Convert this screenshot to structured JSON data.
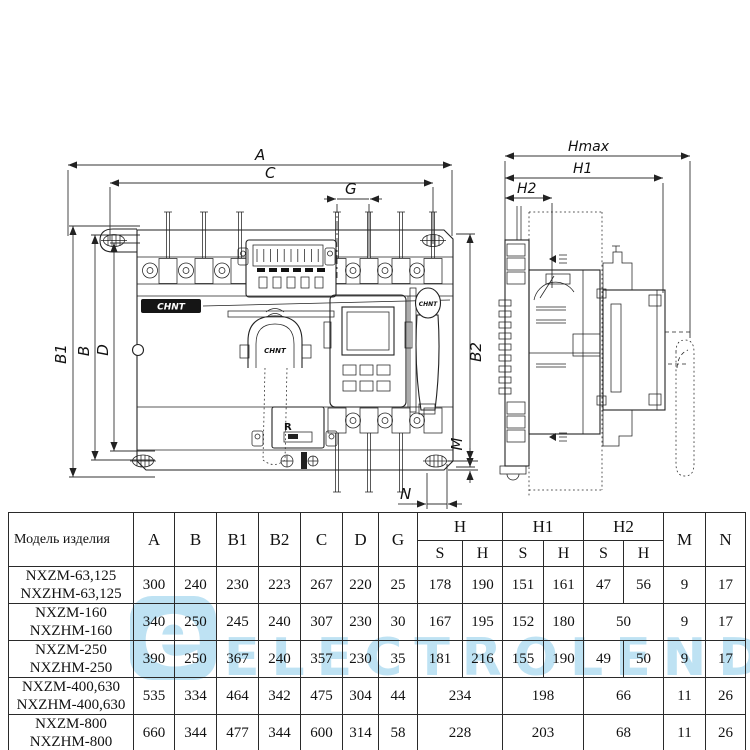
{
  "watermark": {
    "logo_letter": "e",
    "text": "ELECTROLEND",
    "accent_color": "#b3ddf1"
  },
  "drawing": {
    "front_view": {
      "dim_a": "A",
      "dim_c": "C",
      "dim_g": "G",
      "dim_b1": "B1",
      "dim_b": "B",
      "dim_d": "D",
      "dim_b2": "B2",
      "dim_m": "M",
      "dim_n": "N",
      "brand_plate": "CHNT",
      "brand_arch": "CHNT",
      "brand_handle": "CHNT",
      "relay_label": "R"
    },
    "side_view": {
      "dim_hmax": "Hmax",
      "dim_h1": "H1",
      "dim_h2": "H2"
    }
  },
  "table": {
    "header": {
      "model": "Модель изделия",
      "a": "A",
      "b": "B",
      "b1": "B1",
      "b2": "B2",
      "c": "C",
      "d": "D",
      "g": "G",
      "h": "H",
      "h1": "H1",
      "h2": "H2",
      "s1": "S",
      "hh1": "H",
      "s2": "S",
      "hh2": "H",
      "s3": "S",
      "hh3": "H",
      "m": "M",
      "n": "N"
    },
    "rows": [
      {
        "model1": "NXZM-63,125",
        "model2": "NXZHM-63,125",
        "a": "300",
        "b": "240",
        "b1": "230",
        "b2": "223",
        "c": "267",
        "d": "220",
        "g": "25",
        "hs": "178",
        "hh": "190",
        "h1s": "151",
        "h1h": "161",
        "h2s": "47",
        "h2h": "56",
        "m": "9",
        "n": "17"
      },
      {
        "model1": "NXZM-160",
        "model2": "NXZHM-160",
        "a": "340",
        "b": "250",
        "b1": "245",
        "b2": "240",
        "c": "307",
        "d": "230",
        "g": "30",
        "hs": "167",
        "hh": "195",
        "h1s": "152",
        "h1h": "180",
        "h2": "50",
        "m": "9",
        "n": "17"
      },
      {
        "model1": "NXZM-250",
        "model2": "NXZHM-250",
        "a": "390",
        "b": "250",
        "b1": "367",
        "b2": "240",
        "c": "357",
        "d": "230",
        "g": "35",
        "hs": "181",
        "hh": "216",
        "h1s": "155",
        "h1h": "190",
        "h2s": "49",
        "h2h": "50",
        "m": "9",
        "n": "17"
      },
      {
        "model1": "NXZM-400,630",
        "model2": "NXZHM-400,630",
        "a": "535",
        "b": "334",
        "b1": "464",
        "b2": "342",
        "c": "475",
        "d": "304",
        "g": "44",
        "h": "234",
        "h1": "198",
        "h2": "66",
        "m": "11",
        "n": "26"
      },
      {
        "model1": "NXZM-800",
        "model2": "NXZHM-800",
        "a": "660",
        "b": "344",
        "b1": "477",
        "b2": "344",
        "c": "600",
        "d": "314",
        "g": "58",
        "h": "228",
        "h1": "203",
        "h2": "68",
        "m": "11",
        "n": "26"
      }
    ]
  }
}
